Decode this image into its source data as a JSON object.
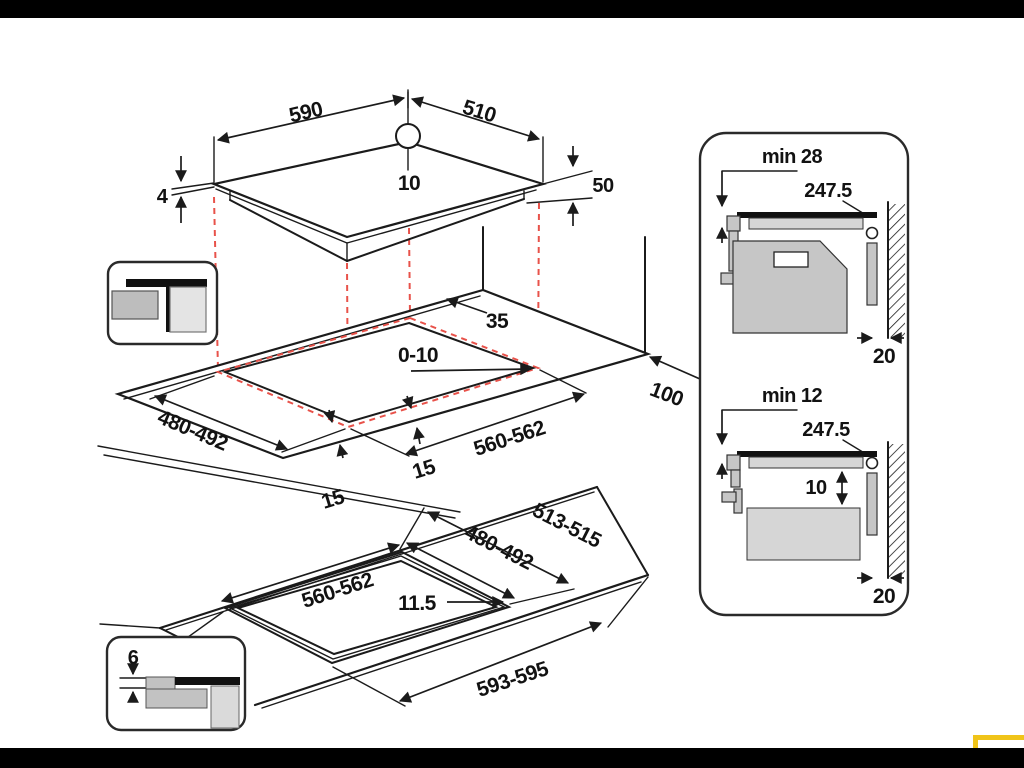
{
  "colors": {
    "line": "#1b1b1b",
    "dash_red": "#e8524a",
    "accent_yellow": "#f0c419",
    "frame": "#000000"
  },
  "hob": {
    "width": "590",
    "depth": "510",
    "rear_offset": "10",
    "glass_thickness": "4",
    "body_height": "50"
  },
  "cutout": {
    "back_clearance": "35",
    "edge_gap": "0-10",
    "depth": "480-492",
    "width": "560-562",
    "front_left": "15",
    "front_right": "15",
    "side_clearance": "100"
  },
  "flush": {
    "outer_depth": "513-515",
    "depth": "480-492",
    "width": "560-562",
    "rim": "11.5",
    "outer_width": "593-595",
    "step": "6"
  },
  "side_top": {
    "min_clearance": "min 28",
    "depth": "247.5",
    "wall_gap": "20"
  },
  "side_bottom": {
    "min_clearance": "min 12",
    "depth": "247.5",
    "drawer_gap": "10",
    "wall_gap": "20"
  }
}
